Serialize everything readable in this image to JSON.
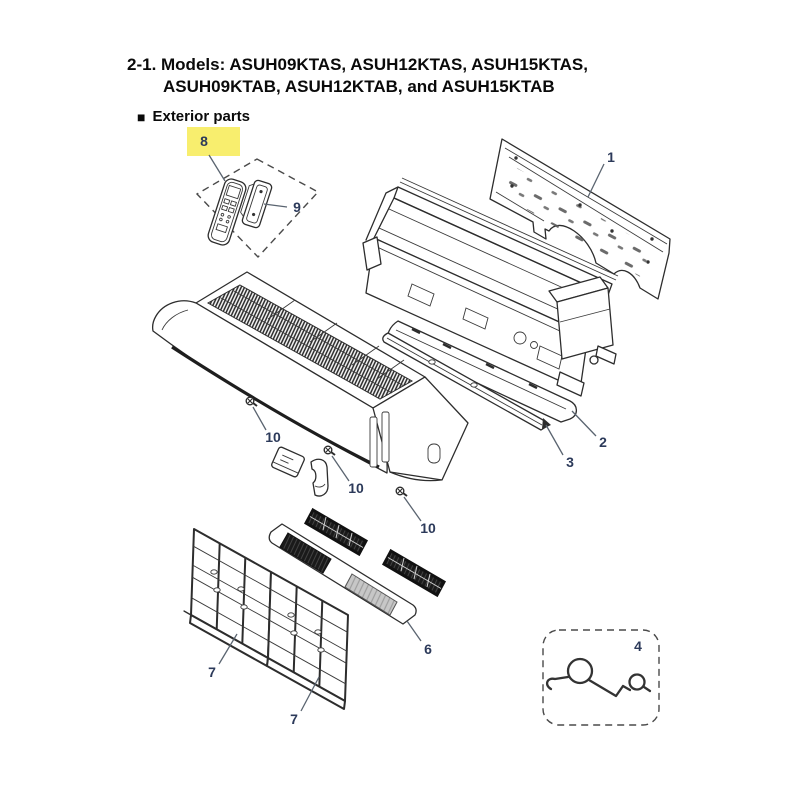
{
  "page": {
    "title_line1": "2-1. Models: ASUH09KTAS, ASUH12KTAS, ASUH15KTAS,",
    "title_line2": "ASUH09KTAB, ASUH12KTAB, and ASUH15KTAB",
    "section_bullet": "■",
    "section_heading": "Exterior parts"
  },
  "diagram": {
    "type": "exploded-parts-diagram",
    "label_color": "#2c3a5a",
    "highlight_color": "#f8ee6e",
    "labels": [
      {
        "number": "1",
        "x": 611,
        "y": 157,
        "leader": [
          604,
          164,
          588,
          197
        ]
      },
      {
        "number": "2",
        "x": 603,
        "y": 442,
        "leader": [
          596,
          436,
          572,
          411
        ]
      },
      {
        "number": "3",
        "x": 570,
        "y": 462,
        "leader": [
          563,
          455,
          546,
          425
        ]
      },
      {
        "number": "4",
        "x": 638,
        "y": 646
      },
      {
        "number": "6",
        "x": 428,
        "y": 649,
        "leader": [
          421,
          641,
          407,
          621
        ]
      },
      {
        "number": "7",
        "x": 212,
        "y": 672,
        "leader": [
          219,
          664,
          237,
          634
        ]
      },
      {
        "number": "7",
        "x": 294,
        "y": 719,
        "leader": [
          301,
          711,
          319,
          677
        ]
      },
      {
        "number": "8",
        "x": 204,
        "y": 141,
        "leader": [
          209,
          155,
          225,
          181
        ],
        "highlight": [
          187,
          127,
          53,
          29
        ]
      },
      {
        "number": "9",
        "x": 297,
        "y": 207,
        "leader": [
          287,
          207,
          264,
          204
        ]
      },
      {
        "number": "10",
        "x": 273,
        "y": 437,
        "leader": [
          266,
          430,
          253,
          407
        ]
      },
      {
        "number": "10",
        "x": 356,
        "y": 488,
        "leader": [
          349,
          481,
          332,
          456
        ]
      },
      {
        "number": "10",
        "x": 428,
        "y": 528,
        "leader": [
          421,
          521,
          404,
          497
        ]
      }
    ]
  }
}
